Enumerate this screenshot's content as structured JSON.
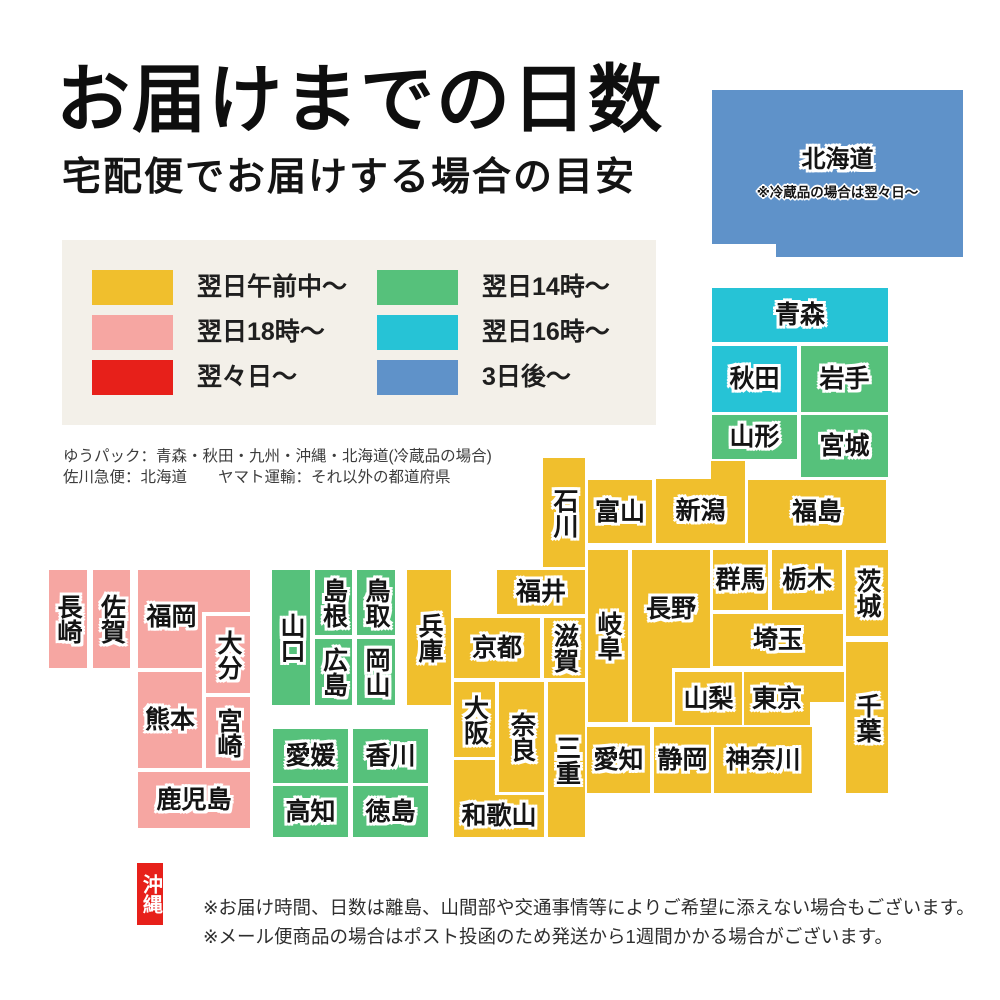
{
  "page": {
    "title": "お届けまでの日数",
    "subtitle": "宅配便でお届けする場合の目安"
  },
  "colors": {
    "yellow": "#f0bf2d",
    "green": "#56c17b",
    "pink": "#f6a6a2",
    "cyan": "#26c3d6",
    "red": "#e7201a",
    "blue": "#5f92c9",
    "panel_bg": "#f3f0e9"
  },
  "legend": {
    "items": [
      {
        "key": "yellow",
        "label": "翌日午前中〜"
      },
      {
        "key": "green",
        "label": "翌日14時〜"
      },
      {
        "key": "pink",
        "label": "翌日18時〜"
      },
      {
        "key": "cyan",
        "label": "翌日16時〜"
      },
      {
        "key": "red",
        "label": "翌々日〜"
      },
      {
        "key": "blue",
        "label": "3日後〜"
      }
    ]
  },
  "carrier_notes": [
    "ゆうパック：青森・秋田・九州・沖縄・北海道(冷蔵品の場合)",
    "佐川急便：北海道　　ヤマト運輸：それ以外の都道府県"
  ],
  "footnotes": [
    "※お届け時間、日数は離島、山間部や交通事情等によりご希望に添えない場合もございます。",
    "※メール便商品の場合はポスト投函のため発送から1週間かかる場合がございます。"
  ],
  "map_blocks": [
    {
      "id": "hokkaido",
      "name": "北海道",
      "color": "blue",
      "x": 712,
      "y": 90,
      "w": 251,
      "h": 167,
      "fs": 24,
      "clip": [
        [
          0,
          0
        ],
        [
          251,
          0
        ],
        [
          251,
          167
        ],
        [
          64,
          167
        ],
        [
          64,
          154
        ],
        [
          0,
          154
        ]
      ],
      "label_box": [
        0,
        42,
        251,
        56
      ],
      "note": "※冷蔵品の場合は翌々日〜",
      "note_y": 96
    },
    {
      "id": "aomori",
      "name": "青森",
      "color": "cyan",
      "x": 712,
      "y": 288,
      "w": 176,
      "h": 54
    },
    {
      "id": "akita",
      "name": "秋田",
      "color": "cyan",
      "x": 712,
      "y": 346,
      "w": 85,
      "h": 66
    },
    {
      "id": "iwate",
      "name": "岩手",
      "color": "green",
      "x": 801,
      "y": 346,
      "w": 87,
      "h": 66
    },
    {
      "id": "yamagata",
      "name": "山形",
      "color": "green",
      "x": 712,
      "y": 415,
      "w": 85,
      "h": 44
    },
    {
      "id": "miyagi",
      "name": "宮城",
      "color": "green",
      "x": 801,
      "y": 415,
      "w": 87,
      "h": 62
    },
    {
      "id": "fukushima",
      "name": "福島",
      "color": "yellow",
      "x": 748,
      "y": 480,
      "w": 138,
      "h": 63
    },
    {
      "id": "niigata",
      "name": "新潟",
      "color": "yellow",
      "x": 656,
      "y": 461,
      "w": 89,
      "h": 82,
      "clip": [
        [
          0,
          18
        ],
        [
          55,
          18
        ],
        [
          55,
          0
        ],
        [
          89,
          0
        ],
        [
          89,
          82
        ],
        [
          0,
          82
        ]
      ],
      "label_box": [
        0,
        18,
        89,
        64
      ]
    },
    {
      "id": "toyama",
      "name": "富山",
      "color": "yellow",
      "x": 588,
      "y": 480,
      "w": 64,
      "h": 63
    },
    {
      "id": "ishikawa",
      "name": "石川",
      "color": "yellow",
      "v": true,
      "x": 543,
      "y": 458,
      "w": 42,
      "h": 109
    },
    {
      "id": "fukui",
      "name": "福井",
      "color": "yellow",
      "x": 497,
      "y": 570,
      "w": 88,
      "h": 44
    },
    {
      "id": "gunma",
      "name": "群馬",
      "color": "yellow",
      "x": 713,
      "y": 550,
      "w": 55,
      "h": 60
    },
    {
      "id": "tochigi",
      "name": "栃木",
      "color": "yellow",
      "x": 772,
      "y": 550,
      "w": 70,
      "h": 60
    },
    {
      "id": "ibaraki",
      "name": "茨城",
      "color": "yellow",
      "v": true,
      "x": 846,
      "y": 550,
      "w": 42,
      "h": 86
    },
    {
      "id": "saitama",
      "name": "埼玉",
      "color": "yellow",
      "x": 713,
      "y": 614,
      "w": 130,
      "h": 52
    },
    {
      "id": "tokyo",
      "name": "東京",
      "color": "yellow",
      "x": 744,
      "y": 672,
      "w": 100,
      "h": 53,
      "clip": [
        [
          0,
          0
        ],
        [
          100,
          0
        ],
        [
          100,
          30
        ],
        [
          66,
          30
        ],
        [
          66,
          53
        ],
        [
          0,
          53
        ]
      ],
      "label_box": [
        0,
        0,
        66,
        53
      ]
    },
    {
      "id": "chiba",
      "name": "千葉",
      "color": "yellow",
      "v": true,
      "x": 846,
      "y": 642,
      "w": 42,
      "h": 151
    },
    {
      "id": "yamanashi",
      "name": "山梨",
      "color": "yellow",
      "x": 675,
      "y": 672,
      "w": 67,
      "h": 53
    },
    {
      "id": "nagano",
      "name": "長野",
      "color": "yellow",
      "x": 632,
      "y": 550,
      "w": 78,
      "h": 172,
      "clip": [
        [
          0,
          0
        ],
        [
          78,
          0
        ],
        [
          78,
          118
        ],
        [
          40,
          118
        ],
        [
          40,
          172
        ],
        [
          0,
          172
        ]
      ],
      "label_box": [
        0,
        0,
        78,
        118
      ]
    },
    {
      "id": "gifu",
      "name": "岐阜",
      "color": "yellow",
      "v": true,
      "x": 588,
      "y": 550,
      "w": 40,
      "h": 172
    },
    {
      "id": "kanagawa",
      "name": "神奈川",
      "color": "yellow",
      "x": 714,
      "y": 727,
      "w": 98,
      "h": 66
    },
    {
      "id": "shizuoka",
      "name": "静岡",
      "color": "yellow",
      "x": 654,
      "y": 727,
      "w": 57,
      "h": 66
    },
    {
      "id": "aichi",
      "name": "愛知",
      "color": "yellow",
      "x": 587,
      "y": 727,
      "w": 63,
      "h": 66
    },
    {
      "id": "mie",
      "name": "三重",
      "color": "yellow",
      "v": true,
      "x": 548,
      "y": 682,
      "w": 37,
      "h": 155
    },
    {
      "id": "shiga",
      "name": "滋賀",
      "color": "yellow",
      "v": true,
      "x": 544,
      "y": 618,
      "w": 41,
      "h": 60
    },
    {
      "id": "kyoto",
      "name": "京都",
      "color": "yellow",
      "x": 454,
      "y": 618,
      "w": 86,
      "h": 60
    },
    {
      "id": "osaka",
      "name": "大阪",
      "color": "yellow",
      "v": true,
      "x": 454,
      "y": 682,
      "w": 41,
      "h": 75
    },
    {
      "id": "nara",
      "name": "奈良",
      "color": "yellow",
      "v": true,
      "x": 499,
      "y": 682,
      "w": 45,
      "h": 110
    },
    {
      "id": "wakayama",
      "name": "和歌山",
      "color": "yellow",
      "x": 454,
      "y": 760,
      "w": 90,
      "h": 77,
      "clip": [
        [
          0,
          0
        ],
        [
          41,
          0
        ],
        [
          41,
          35
        ],
        [
          90,
          35
        ],
        [
          90,
          77
        ],
        [
          0,
          77
        ]
      ],
      "label_box": [
        0,
        35,
        90,
        42
      ]
    },
    {
      "id": "hyogo",
      "name": "兵庫",
      "color": "yellow",
      "v": true,
      "x": 407,
      "y": 570,
      "w": 44,
      "h": 135
    },
    {
      "id": "tottori",
      "name": "鳥取",
      "color": "green",
      "v": true,
      "x": 357,
      "y": 570,
      "w": 38,
      "h": 65
    },
    {
      "id": "shimane",
      "name": "島根",
      "color": "green",
      "v": true,
      "x": 315,
      "y": 570,
      "w": 37,
      "h": 65
    },
    {
      "id": "okayama",
      "name": "岡山",
      "color": "green",
      "v": true,
      "x": 357,
      "y": 639,
      "w": 38,
      "h": 66
    },
    {
      "id": "hiroshima",
      "name": "広島",
      "color": "green",
      "v": true,
      "x": 315,
      "y": 639,
      "w": 37,
      "h": 66
    },
    {
      "id": "yamaguchi",
      "name": "山口",
      "color": "green",
      "v": true,
      "x": 272,
      "y": 570,
      "w": 38,
      "h": 135
    },
    {
      "id": "kagawa",
      "name": "香川",
      "color": "green",
      "x": 353,
      "y": 729,
      "w": 75,
      "h": 54
    },
    {
      "id": "ehime",
      "name": "愛媛",
      "color": "green",
      "x": 273,
      "y": 729,
      "w": 75,
      "h": 54
    },
    {
      "id": "tokushima",
      "name": "徳島",
      "color": "green",
      "x": 353,
      "y": 786,
      "w": 75,
      "h": 51
    },
    {
      "id": "kochi",
      "name": "高知",
      "color": "green",
      "x": 273,
      "y": 786,
      "w": 75,
      "h": 51
    },
    {
      "id": "fukuoka",
      "name": "福岡",
      "color": "pink",
      "x": 138,
      "y": 570,
      "w": 112,
      "h": 98,
      "clip": [
        [
          0,
          0
        ],
        [
          112,
          0
        ],
        [
          112,
          42
        ],
        [
          64,
          42
        ],
        [
          64,
          98
        ],
        [
          0,
          98
        ]
      ],
      "label_box": [
        0,
        18,
        67,
        58
      ]
    },
    {
      "id": "saga",
      "name": "佐賀",
      "color": "pink",
      "v": true,
      "x": 93,
      "y": 570,
      "w": 37,
      "h": 98
    },
    {
      "id": "nagasaki",
      "name": "長崎",
      "color": "pink",
      "v": true,
      "x": 49,
      "y": 570,
      "w": 38,
      "h": 98
    },
    {
      "id": "oita",
      "name": "大分",
      "color": "pink",
      "v": true,
      "x": 206,
      "y": 616,
      "w": 44,
      "h": 77
    },
    {
      "id": "kumamoto",
      "name": "熊本",
      "color": "pink",
      "x": 138,
      "y": 672,
      "w": 64,
      "h": 96
    },
    {
      "id": "miyazaki",
      "name": "宮崎",
      "color": "pink",
      "v": true,
      "x": 206,
      "y": 697,
      "w": 44,
      "h": 71
    },
    {
      "id": "kagoshima",
      "name": "鹿児島",
      "color": "pink",
      "x": 138,
      "y": 772,
      "w": 112,
      "h": 56
    },
    {
      "id": "okinawa",
      "name": "沖縄",
      "color": "red",
      "v": true,
      "x": 137,
      "y": 863,
      "w": 26,
      "h": 62,
      "fs": 20,
      "plain": true
    }
  ]
}
